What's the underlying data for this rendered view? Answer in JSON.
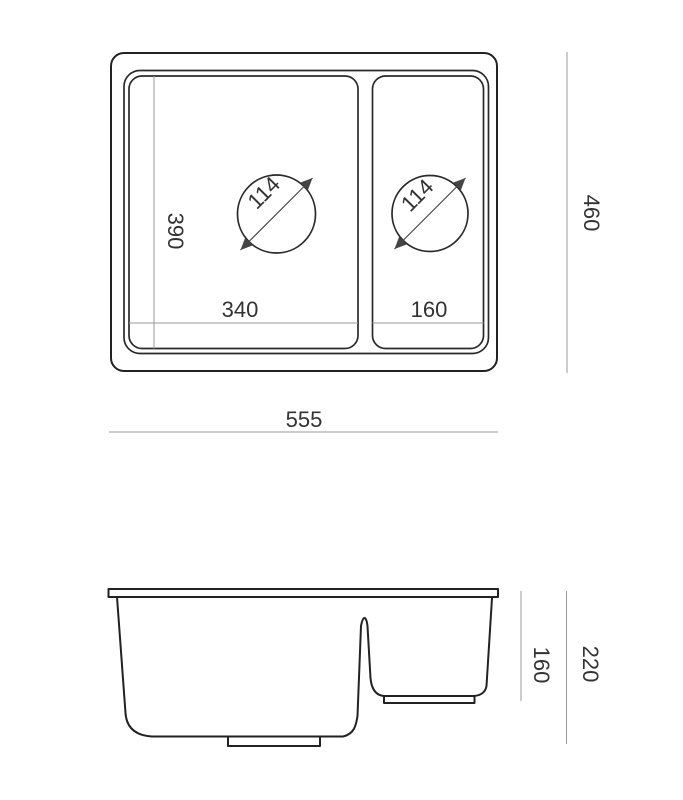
{
  "drawing": {
    "type": "sink-technical-drawing",
    "background_color": "#ffffff",
    "outline_color": "#222222",
    "dimension_line_color": "#999999",
    "text_color": "#333333",
    "top_view": {
      "dimensions": {
        "overall_width": "555",
        "overall_depth": "460",
        "basin_interior_depth": "390",
        "large_basin_width": "340",
        "small_basin_width": "160",
        "large_drain_diameter": "114",
        "small_drain_diameter": "114"
      }
    },
    "side_view": {
      "dimensions": {
        "overall_height": "220",
        "small_basin_height": "160"
      }
    }
  }
}
